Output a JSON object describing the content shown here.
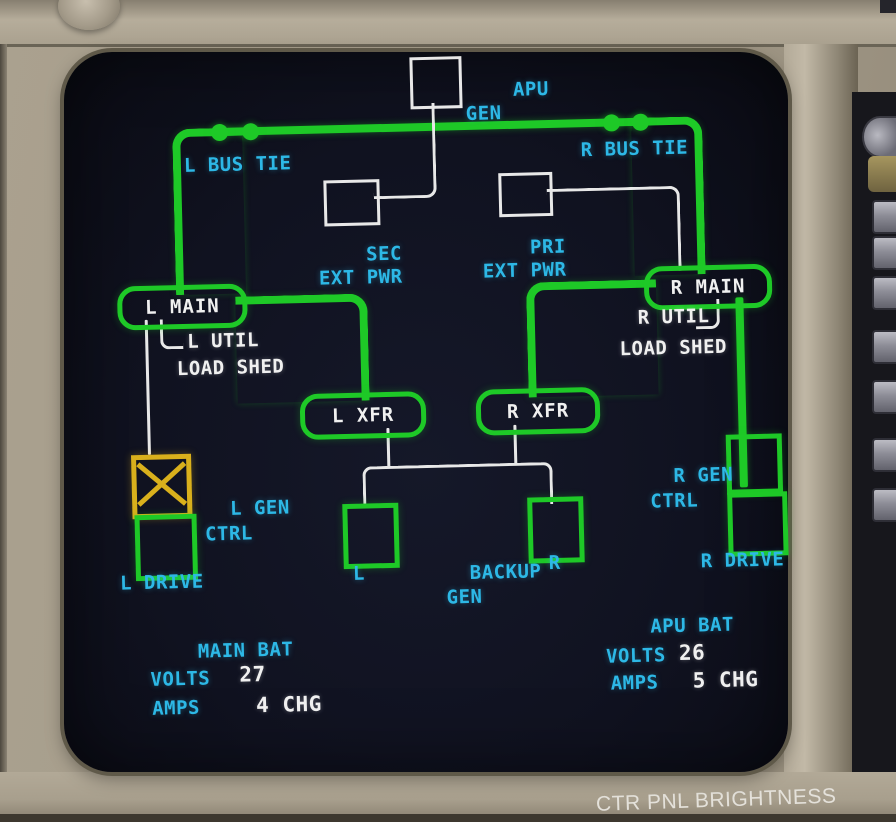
{
  "screen": {
    "apu_gen": {
      "line1": "APU",
      "line2": "GEN"
    },
    "bus_ties": {
      "left": "L BUS TIE",
      "right": "R BUS TIE"
    },
    "ext_pwr": {
      "sec": {
        "line1": "SEC",
        "line2": "EXT PWR"
      },
      "pri": {
        "line1": "PRI",
        "line2": "EXT PWR"
      }
    },
    "buses": {
      "l_main": "L MAIN",
      "r_main": "R MAIN",
      "l_xfr": "L XFR",
      "r_xfr": "R XFR"
    },
    "util": {
      "l_label": "L UTIL",
      "l_status": "LOAD SHED",
      "r_label": "R UTIL",
      "r_status": "LOAD SHED"
    },
    "gen": {
      "l_ctrl": {
        "line1": "L GEN",
        "line2": "CTRL"
      },
      "r_ctrl": {
        "line1": "R GEN",
        "line2": "CTRL"
      },
      "l_drive": "L DRIVE",
      "r_drive": "R DRIVE"
    },
    "backup": {
      "title1": "BACKUP",
      "title2": "GEN",
      "left": "L",
      "right": "R"
    },
    "main_bat": {
      "title": "MAIN BAT",
      "volts_label": "VOLTS",
      "volts": "27",
      "amps_label": "AMPS",
      "amps": "4 CHG"
    },
    "apu_bat": {
      "title": "APU BAT",
      "volts_label": "VOLTS",
      "volts": "26",
      "amps_label": "AMPS",
      "amps": "5 CHG"
    }
  },
  "panel": {
    "placard": "CTR PNL BRIGHTNESS"
  },
  "colors": {
    "bus_green": "#1ec927",
    "label_cyan": "#2db8e6",
    "text_white": "#f0f0f0",
    "fault_amber": "#d9b01c",
    "screen_bg": "#101220",
    "panel_tan": "#a89f8d"
  }
}
